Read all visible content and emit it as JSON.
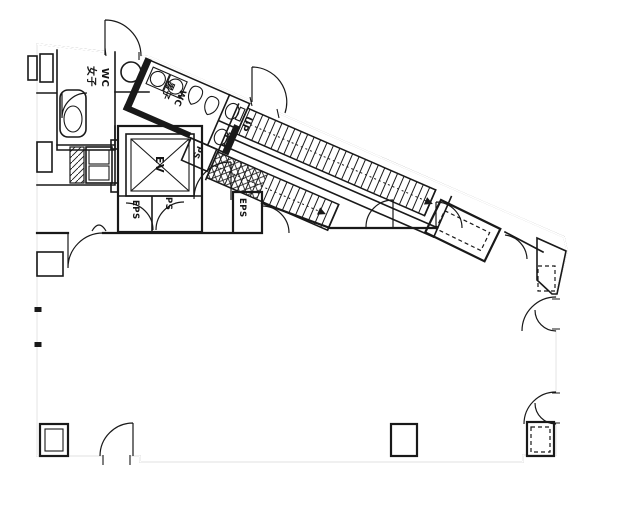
{
  "plan": {
    "rooms": {
      "womens_wc": {
        "jp": "女子",
        "en": "WC"
      },
      "mens_wc": {
        "jp": "男子",
        "en": "WC"
      },
      "elevator": {
        "label": "EV"
      },
      "eps_shaft_under_elevator": {
        "label": "EPS"
      },
      "ps_shaft_under_elevator": {
        "label": "PS"
      },
      "ps_shaft_upper": {
        "label": "PS"
      },
      "eps_shaft_corridor": {
        "label": "EPS"
      },
      "stairs": {
        "direction_label": "UP"
      }
    }
  }
}
